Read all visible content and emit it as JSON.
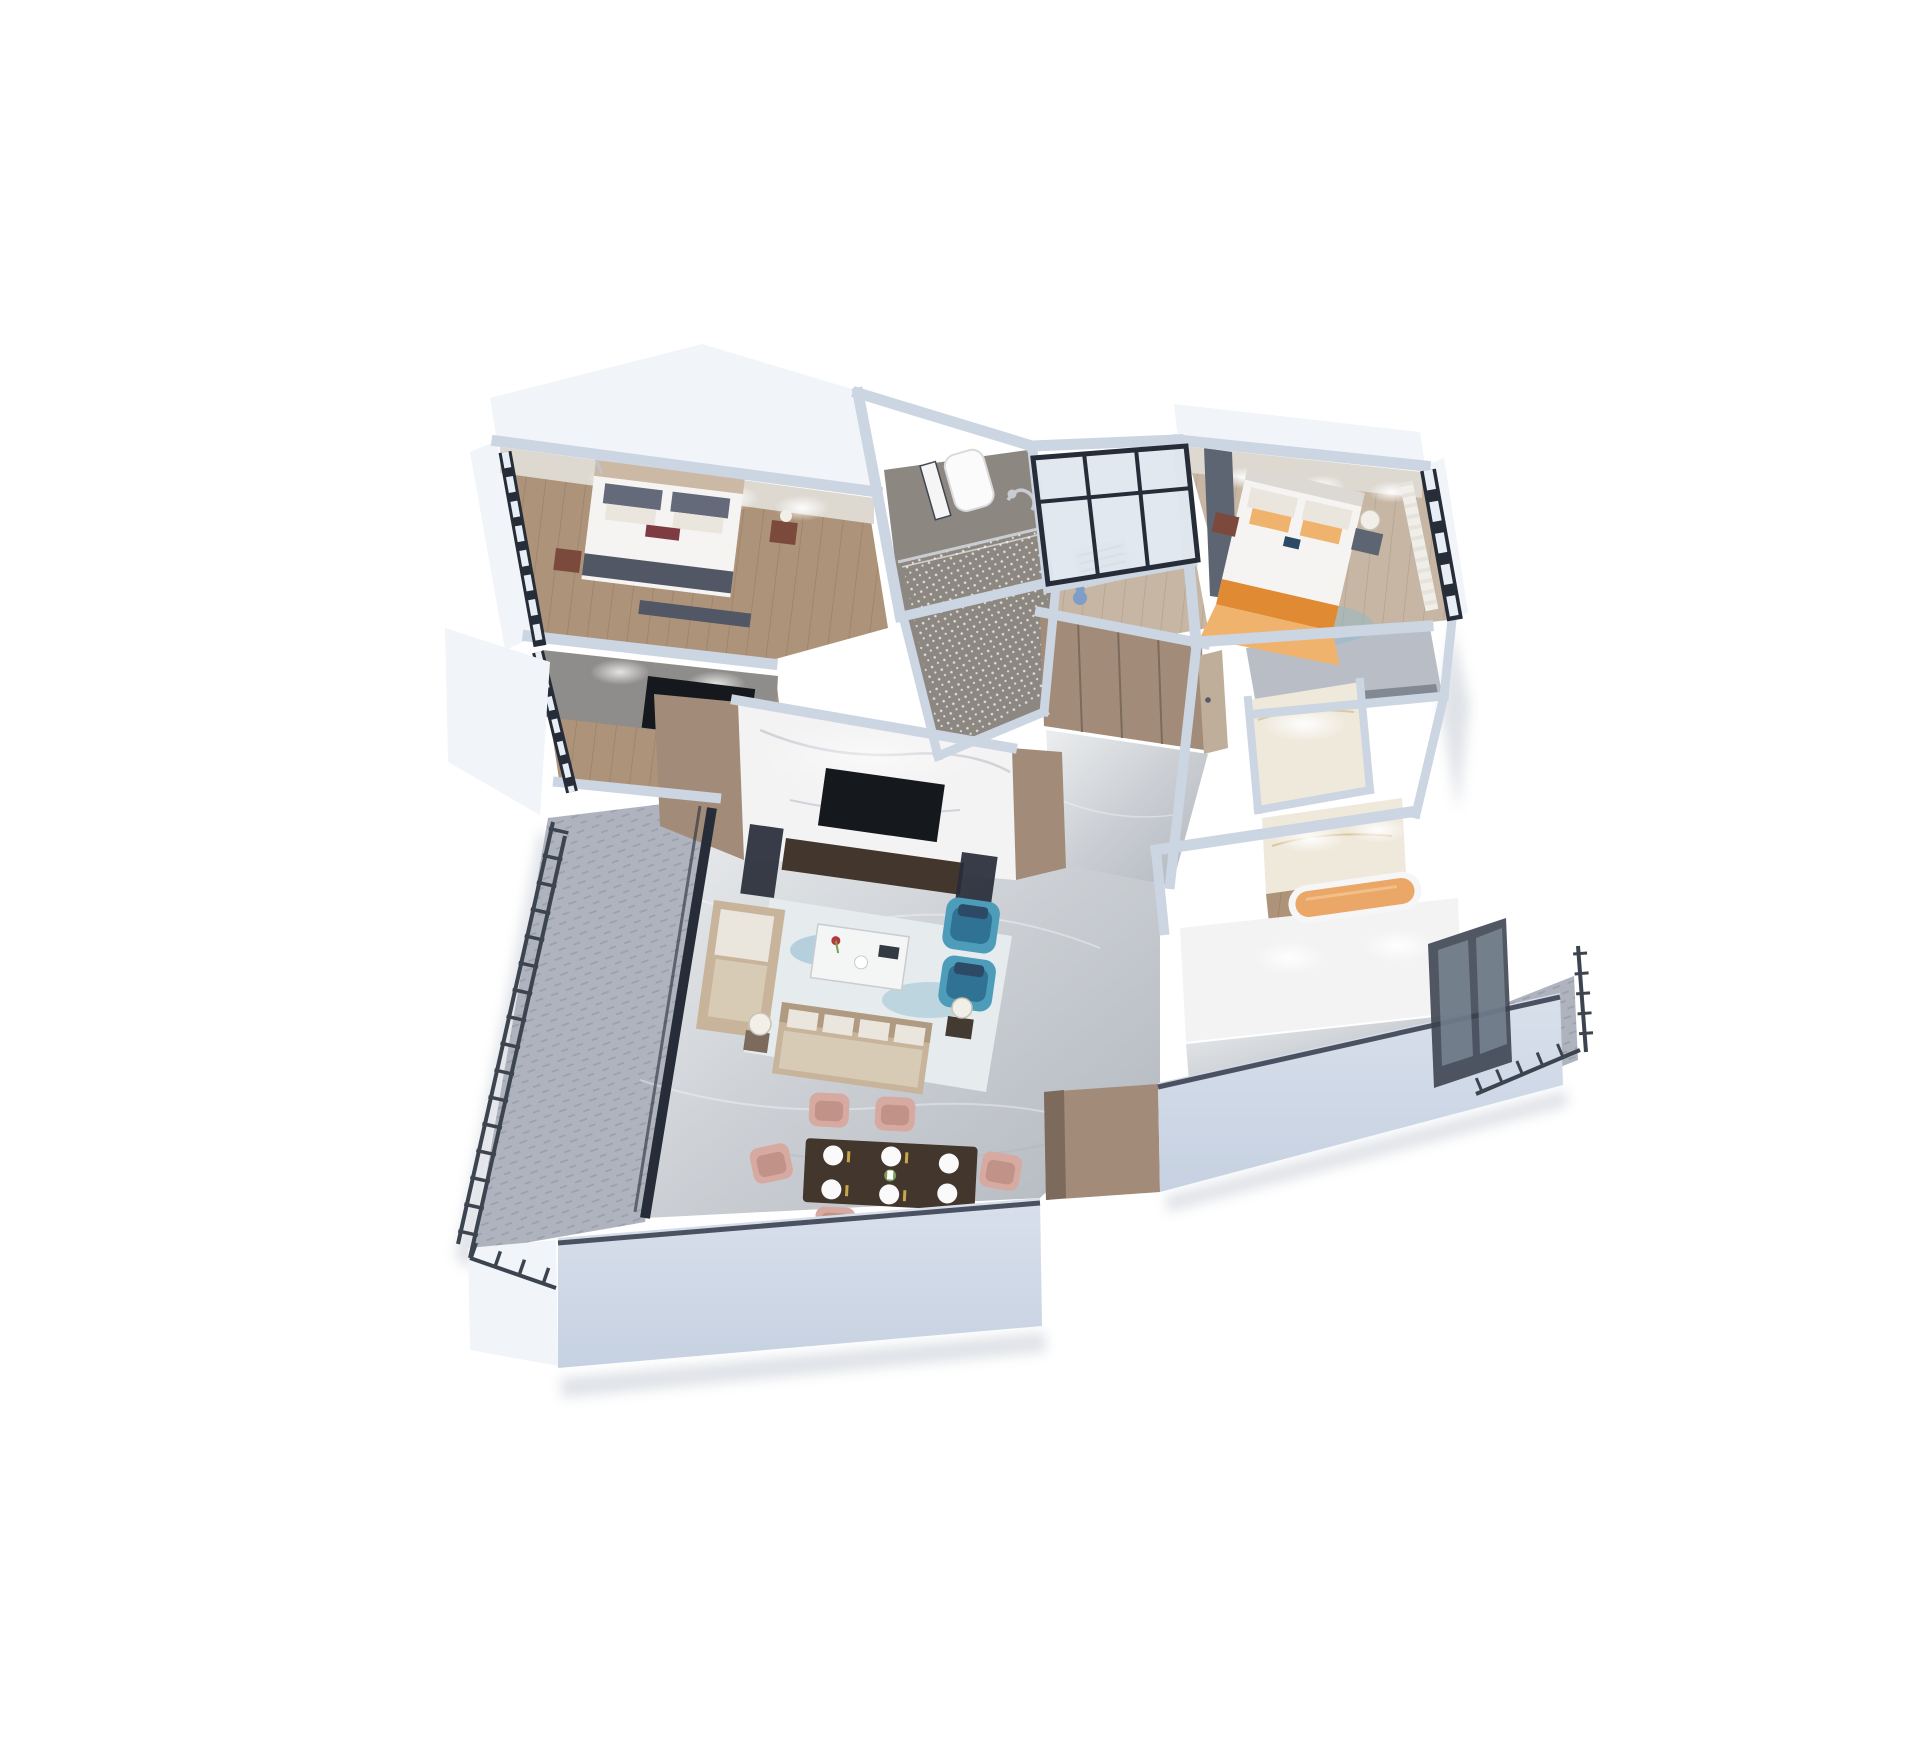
{
  "scene": {
    "title": "isometric-3d-apartment-floor-plan-render",
    "rooms": [
      "master-bedroom",
      "master-tv-room",
      "bathroom",
      "study-room",
      "bedroom-2",
      "closet-room",
      "small-bathroom",
      "hallway-entry",
      "living-room",
      "dining-area",
      "bathtub-room",
      "south-bathroom",
      "left-balcony",
      "right-balcony"
    ]
  },
  "colors": {
    "background": "#ffffff",
    "wall-top": "#ccd5e2",
    "wall-top-light": "#dee5ef",
    "wall-ext": "#f1f4f8",
    "wall-front": "#c6d1e1",
    "wall-front-light": "#d9e0ec",
    "wall-int-lit": "#ddd8d0",
    "wall-grey": "#8e8d8b",
    "skirting": "#4a5160",
    "wood": "#ad9379",
    "wood-line": "#9a8068",
    "wood-pale": "#c6b6a3",
    "wood-pale-line": "#b0a08e",
    "marble-dark": "#a9aeb5",
    "marble-bright": "#f3f3f4",
    "marble-gold": "#efe9dc",
    "gold-vein": "#cdb27a",
    "tile-dark": "#8d8781",
    "sparkle": "#e8e5e1",
    "carpet": "#aeb3bd",
    "carpet-line": "#999fab",
    "railing": "#3c4450",
    "frame-dark": "#272d38",
    "glass": "#e8eef5",
    "curtain": "#f3f1ed",
    "tan": "#a28c79",
    "tan-dark": "#7c6a5c",
    "door": "#bfae9a",
    "slate": "#5d6572",
    "sofa": "#c8b49b",
    "sofa-dark": "#b09a81",
    "sofa-seat": "#d8cbb6",
    "cushion": "#eae5dd",
    "pillow-dark": "#646a7a",
    "runner": "#515764",
    "maroon": "#7e3b42",
    "redwood": "#7b4a3c",
    "armchair": "#4d9cba",
    "armchair-dark": "#2f7294",
    "navy": "#2c4a66",
    "rug": "#e6ebee",
    "rug-blue": "#8cbacd",
    "table-white": "#f4f5f5",
    "dining-table": "#43362c",
    "chair-pink": "#d6aaa0",
    "chair-pink-dark": "#c19287",
    "bed-white": "#f5f4f2",
    "bed-shadow": "#dcd9d4",
    "headboard": "#cbb9a5",
    "orange": "#e08a33",
    "orange-light": "#f0b36e",
    "tub": "#eaa768",
    "tv-dark": "#15181d",
    "lamp": "#f2efe8",
    "plate": "#fafafa",
    "gold": "#c9a84c",
    "green": "#7a9f5a",
    "red": "#b43a3a",
    "doll-blue": "#7f9dc9",
    "shadow": "#b9c0cb"
  }
}
